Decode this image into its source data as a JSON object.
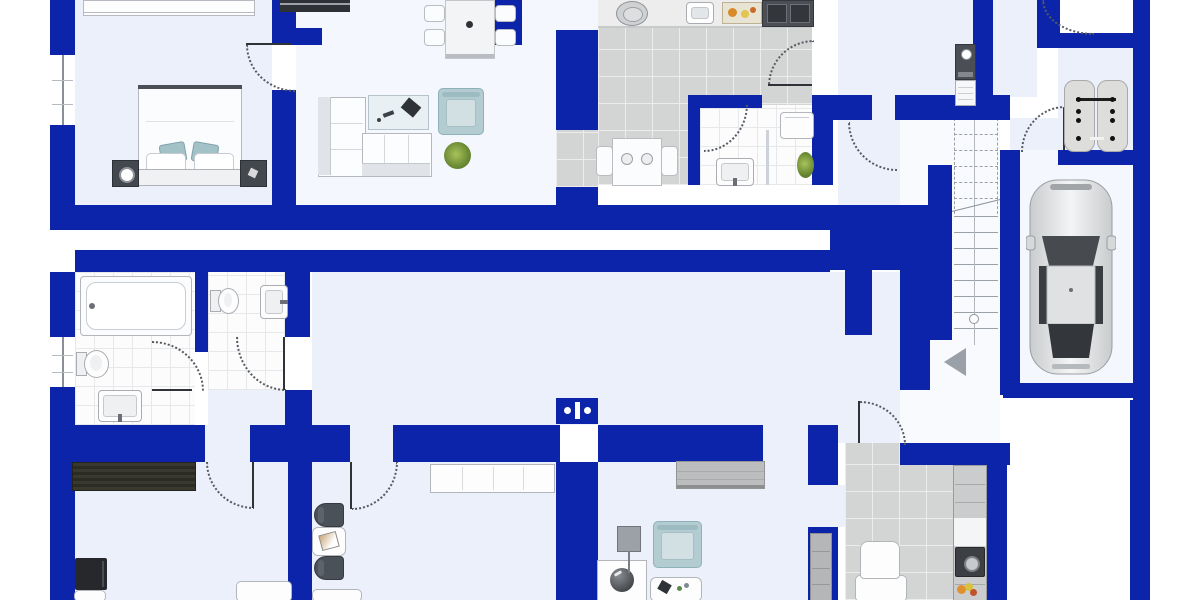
{
  "meta": {
    "title": "apartment-floor-plan"
  },
  "colors": {
    "wall": "#0c24a9",
    "floor_light": "#ebf0fb",
    "floor_bright": "#f4f7fe",
    "tile_gray": "#d3d4d4",
    "tile_white": "#fcfcfd",
    "accent_teal": "#b3ccd1",
    "dark": "#2e3136",
    "line": "#9aa0a8"
  },
  "plan": {
    "floors": [
      {
        "n": "bedroom",
        "t": "light",
        "x": 75,
        "y": 0,
        "w": 197,
        "h": 205
      },
      {
        "n": "living-room",
        "t": "bright",
        "x": 296,
        "y": 0,
        "w": 260,
        "h": 205
      },
      {
        "n": "living-kitchen-top",
        "t": "bright",
        "x": 556,
        "y": 0,
        "w": 42,
        "h": 30
      },
      {
        "n": "kitchen",
        "t": "gray",
        "x": 598,
        "y": 0,
        "w": 214,
        "h": 185
      },
      {
        "n": "kitchen-pass",
        "t": "gray",
        "x": 556,
        "y": 130,
        "w": 42,
        "h": 57
      },
      {
        "n": "bathroom-top",
        "t": "white",
        "x": 700,
        "y": 105,
        "w": 112,
        "h": 80
      },
      {
        "n": "hall-top",
        "t": "light",
        "x": 838,
        "y": 0,
        "w": 135,
        "h": 205
      },
      {
        "n": "hall-top-b",
        "t": "light",
        "x": 993,
        "y": 0,
        "w": 44,
        "h": 35
      },
      {
        "n": "hall-top-c",
        "t": "light",
        "x": 993,
        "y": 35,
        "w": 44,
        "h": 62
      },
      {
        "n": "hall-top-d",
        "t": "light",
        "x": 1010,
        "y": 118,
        "w": 48,
        "h": 32
      },
      {
        "n": "storage-room",
        "t": "light",
        "x": 1058,
        "y": 47,
        "w": 75,
        "h": 103
      },
      {
        "n": "garage",
        "t": "bright",
        "x": 1018,
        "y": 160,
        "w": 115,
        "h": 223
      },
      {
        "n": "garage-entry",
        "t": "bright",
        "x": 1018,
        "y": 150,
        "w": 40,
        "h": 15
      },
      {
        "n": "corridor-strip",
        "t": "plain",
        "x": 75,
        "y": 230,
        "w": 755,
        "h": 20
      },
      {
        "n": "hall-lower",
        "t": "light",
        "x": 312,
        "y": 272,
        "w": 588,
        "h": 153
      },
      {
        "n": "stair-hall",
        "t": "plainb",
        "x": 900,
        "y": 120,
        "w": 100,
        "h": 323
      },
      {
        "n": "bathroom-lower",
        "t": "white",
        "x": 75,
        "y": 272,
        "w": 120,
        "h": 153
      },
      {
        "n": "wc",
        "t": "white",
        "x": 208,
        "y": 272,
        "w": 77,
        "h": 118
      },
      {
        "n": "wc-lower",
        "t": "light",
        "x": 208,
        "y": 390,
        "w": 77,
        "h": 35
      },
      {
        "n": "room-bottom-left",
        "t": "light",
        "x": 75,
        "y": 462,
        "w": 213,
        "h": 138
      },
      {
        "n": "corridor-lower",
        "t": "light",
        "x": 312,
        "y": 462,
        "w": 244,
        "h": 138
      },
      {
        "n": "room-bottom-mid",
        "t": "light",
        "x": 598,
        "y": 462,
        "w": 210,
        "h": 138
      },
      {
        "n": "door-gap-mid",
        "t": "light",
        "x": 808,
        "y": 485,
        "w": 37,
        "h": 42
      },
      {
        "n": "kitchen-lower",
        "t": "gray",
        "x": 845,
        "y": 443,
        "w": 140,
        "h": 157
      },
      {
        "n": "entry-gap",
        "t": "light",
        "x": 838,
        "y": 398,
        "w": 62,
        "h": 45
      },
      {
        "n": "band-gap-1",
        "t": "light",
        "x": 205,
        "y": 425,
        "w": 45,
        "h": 37
      },
      {
        "n": "band-gap-2",
        "t": "light",
        "x": 350,
        "y": 425,
        "w": 43,
        "h": 37
      },
      {
        "n": "band-gap-3",
        "t": "light",
        "x": 763,
        "y": 425,
        "w": 45,
        "h": 37
      },
      {
        "n": "stairs-bg",
        "t": "plainb",
        "x": 952,
        "y": 118,
        "w": 48,
        "h": 227
      }
    ],
    "walls": [
      {
        "x": 50,
        "y": 0,
        "w": 25,
        "h": 55
      },
      {
        "x": 50,
        "y": 125,
        "w": 25,
        "h": 80
      },
      {
        "x": 272,
        "y": 0,
        "w": 24,
        "h": 45
      },
      {
        "x": 296,
        "y": 28,
        "w": 26,
        "h": 17
      },
      {
        "x": 272,
        "y": 90,
        "w": 24,
        "h": 115
      },
      {
        "x": 480,
        "y": 0,
        "w": 42,
        "h": 45
      },
      {
        "x": 556,
        "y": 30,
        "w": 42,
        "h": 100
      },
      {
        "x": 556,
        "y": 187,
        "w": 42,
        "h": 18
      },
      {
        "x": 50,
        "y": 205,
        "w": 805,
        "h": 25
      },
      {
        "x": 830,
        "y": 205,
        "w": 115,
        "h": 65
      },
      {
        "x": 75,
        "y": 250,
        "w": 755,
        "h": 22
      },
      {
        "x": 688,
        "y": 95,
        "w": 74,
        "h": 13
      },
      {
        "x": 688,
        "y": 108,
        "w": 12,
        "h": 77
      },
      {
        "x": 812,
        "y": 95,
        "w": 60,
        "h": 25
      },
      {
        "x": 895,
        "y": 95,
        "w": 115,
        "h": 25
      },
      {
        "x": 812,
        "y": 120,
        "w": 21,
        "h": 65
      },
      {
        "x": 973,
        "y": 0,
        "w": 20,
        "h": 110
      },
      {
        "x": 1037,
        "y": 0,
        "w": 23,
        "h": 35
      },
      {
        "x": 1037,
        "y": 33,
        "w": 98,
        "h": 15
      },
      {
        "x": 1058,
        "y": 150,
        "w": 77,
        "h": 15
      },
      {
        "x": 1133,
        "y": 0,
        "w": 17,
        "h": 403
      },
      {
        "x": 928,
        "y": 165,
        "w": 24,
        "h": 175
      },
      {
        "x": 1000,
        "y": 150,
        "w": 20,
        "h": 245
      },
      {
        "x": 1003,
        "y": 383,
        "w": 140,
        "h": 15
      },
      {
        "x": 845,
        "y": 270,
        "w": 27,
        "h": 65
      },
      {
        "x": 900,
        "y": 270,
        "w": 30,
        "h": 120
      },
      {
        "x": 1130,
        "y": 400,
        "w": 20,
        "h": 200
      },
      {
        "x": 50,
        "y": 272,
        "w": 25,
        "h": 65
      },
      {
        "x": 50,
        "y": 387,
        "w": 25,
        "h": 213
      },
      {
        "x": 195,
        "y": 272,
        "w": 13,
        "h": 80
      },
      {
        "x": 285,
        "y": 272,
        "w": 25,
        "h": 65
      },
      {
        "x": 285,
        "y": 390,
        "w": 27,
        "h": 35
      },
      {
        "x": 50,
        "y": 425,
        "w": 155,
        "h": 37
      },
      {
        "x": 250,
        "y": 425,
        "w": 100,
        "h": 37
      },
      {
        "x": 393,
        "y": 425,
        "w": 167,
        "h": 37
      },
      {
        "x": 598,
        "y": 425,
        "w": 165,
        "h": 37
      },
      {
        "x": 808,
        "y": 425,
        "w": 30,
        "h": 60
      },
      {
        "x": 808,
        "y": 527,
        "w": 30,
        "h": 73
      },
      {
        "x": 288,
        "y": 462,
        "w": 24,
        "h": 138
      },
      {
        "x": 556,
        "y": 462,
        "w": 42,
        "h": 138
      },
      {
        "x": 900,
        "y": 443,
        "w": 110,
        "h": 22
      },
      {
        "x": 985,
        "y": 443,
        "w": 22,
        "h": 157
      }
    ],
    "windows": [
      {
        "n": "window-bedroom",
        "x": 50,
        "y": 55,
        "w": 25,
        "h": 70
      },
      {
        "n": "window-bathroom",
        "x": 50,
        "y": 337,
        "w": 25,
        "h": 50
      }
    ],
    "doors": [
      {
        "n": "door-bedroom",
        "x": 246,
        "y": 45,
        "w": 48,
        "h": 45,
        "c": "bl",
        "leaf": {
          "x": 246,
          "y": 43,
          "w": 46,
          "h": 2
        }
      },
      {
        "n": "door-kitchen",
        "x": 768,
        "y": 40,
        "w": 44,
        "h": 44,
        "c": "tl",
        "leaf": {
          "x": 768,
          "y": 84,
          "w": 44,
          "h": 2
        }
      },
      {
        "n": "door-bath-top",
        "x": 704,
        "y": 104,
        "w": 42,
        "h": 46,
        "c": "br"
      },
      {
        "n": "door-storage",
        "x": 1021,
        "y": 106,
        "w": 42,
        "h": 44,
        "c": "tl",
        "leaf": {
          "x": 1063,
          "y": 108,
          "w": 2,
          "h": 42
        }
      },
      {
        "n": "door-entry-top",
        "x": 1042,
        "y": 0,
        "w": 50,
        "h": 33,
        "c": "bl"
      },
      {
        "n": "door-hall",
        "x": 848,
        "y": 122,
        "w": 47,
        "h": 47,
        "c": "bl"
      },
      {
        "n": "door-wc",
        "x": 236,
        "y": 337,
        "w": 48,
        "h": 52,
        "c": "bl",
        "leaf": {
          "x": 283,
          "y": 337,
          "w": 2,
          "h": 53
        }
      },
      {
        "n": "door-bath-lower",
        "x": 152,
        "y": 341,
        "w": 50,
        "h": 48,
        "c": "tr",
        "leaf": {
          "x": 152,
          "y": 389,
          "w": 40,
          "h": 2
        }
      },
      {
        "n": "door-room-left",
        "x": 206,
        "y": 462,
        "w": 46,
        "h": 45,
        "c": "bl",
        "leaf": {
          "x": 252,
          "y": 462,
          "w": 2,
          "h": 46
        }
      },
      {
        "n": "door-corridor",
        "x": 352,
        "y": 462,
        "w": 44,
        "h": 46,
        "c": "br",
        "leaf": {
          "x": 350,
          "y": 462,
          "w": 2,
          "h": 47
        }
      },
      {
        "n": "door-kitchen-lower",
        "x": 860,
        "y": 401,
        "w": 44,
        "h": 42,
        "c": "tr",
        "leaf": {
          "x": 858,
          "y": 401,
          "w": 2,
          "h": 42
        }
      }
    ],
    "stairs": {
      "x": 952,
      "y": 118,
      "w": 48,
      "dashed": [
        118,
        134,
        150,
        166,
        182,
        198
      ],
      "solid": [
        216,
        232,
        248,
        264,
        280,
        296,
        312,
        328
      ],
      "center": 974,
      "diag": {
        "x": 950,
        "y": 205,
        "w": 52
      },
      "circle": {
        "x": 969,
        "y": 314
      }
    },
    "furniture": [
      {
        "n": "wardrobe",
        "t": "wardrobe",
        "x": 83,
        "y": 0,
        "w": 170,
        "h": 14
      },
      {
        "n": "double-bed",
        "t": "bed",
        "x": 138,
        "y": 85,
        "w": 104,
        "h": 101
      },
      {
        "n": "nightstand-left",
        "t": "nightstand",
        "x": 112,
        "y": 160,
        "w": 25,
        "h": 25,
        "lamp": true
      },
      {
        "n": "nightstand-right",
        "t": "nightstand",
        "x": 240,
        "y": 160,
        "w": 25,
        "h": 25
      },
      {
        "n": "piano",
        "t": "piano",
        "x": 280,
        "y": 0,
        "w": 70,
        "h": 12
      },
      {
        "n": "dining-table",
        "t": "table",
        "x": 445,
        "y": 0,
        "w": 48,
        "h": 57
      },
      {
        "n": "dining-chair-1",
        "t": "chair",
        "x": 424,
        "y": 5,
        "w": 19,
        "h": 15
      },
      {
        "n": "dining-chair-2",
        "t": "chair",
        "x": 424,
        "y": 29,
        "w": 19,
        "h": 15
      },
      {
        "n": "dining-chair-3",
        "t": "chair",
        "x": 495,
        "y": 5,
        "w": 19,
        "h": 15
      },
      {
        "n": "dining-chair-4",
        "t": "chair",
        "x": 495,
        "y": 29,
        "w": 19,
        "h": 15
      },
      {
        "n": "corner-sofa",
        "t": "sofa",
        "x": 318,
        "y": 97,
        "w": 112,
        "h": 78
      },
      {
        "n": "coffee-table",
        "t": "ctable",
        "x": 368,
        "y": 95,
        "w": 59,
        "h": 33
      },
      {
        "n": "armchair",
        "t": "armchair",
        "x": 438,
        "y": 88,
        "w": 44,
        "h": 45
      },
      {
        "n": "plant",
        "t": "plant",
        "x": 444,
        "y": 142,
        "w": 27,
        "h": 27
      },
      {
        "n": "kitchen-counter",
        "t": "counter",
        "x": 598,
        "y": 0,
        "w": 214,
        "h": 26
      },
      {
        "n": "pot",
        "t": "pot",
        "x": 616,
        "y": 1,
        "w": 30,
        "h": 23
      },
      {
        "n": "kitchen-sink",
        "t": "ksink",
        "x": 686,
        "y": 2,
        "w": 26,
        "h": 20
      },
      {
        "n": "cutting-board",
        "t": "board",
        "x": 722,
        "y": 2,
        "w": 38,
        "h": 20
      },
      {
        "n": "stove",
        "t": "stove",
        "x": 762,
        "y": 0,
        "w": 50,
        "h": 25
      },
      {
        "n": "kitchen-table",
        "t": "ktable",
        "x": 612,
        "y": 138,
        "w": 48,
        "h": 46
      },
      {
        "n": "kitchen-chair-1",
        "t": "chairv",
        "x": 596,
        "y": 146,
        "w": 15,
        "h": 28
      },
      {
        "n": "kitchen-chair-2",
        "t": "chairv",
        "x": 661,
        "y": 146,
        "w": 15,
        "h": 28
      },
      {
        "n": "bath-top-sink",
        "t": "sink",
        "x": 716,
        "y": 158,
        "w": 36,
        "h": 26,
        "f": "b"
      },
      {
        "n": "washing-machine",
        "t": "washer",
        "x": 780,
        "y": 112,
        "w": 32,
        "h": 25
      },
      {
        "n": "bath-top-plant",
        "t": "plant",
        "x": 797,
        "y": 152,
        "w": 17,
        "h": 26
      },
      {
        "n": "bath-divider",
        "t": "divider",
        "x": 766,
        "y": 130,
        "w": 3,
        "h": 55
      },
      {
        "n": "water-heater",
        "t": "heater",
        "x": 955,
        "y": 44,
        "w": 19,
        "h": 34
      },
      {
        "n": "radiator",
        "t": "radiator",
        "x": 955,
        "y": 80,
        "w": 19,
        "h": 24
      },
      {
        "n": "storage-pads",
        "t": "pads",
        "x": 1064,
        "y": 80,
        "w": 64,
        "h": 70
      },
      {
        "n": "car",
        "t": "car",
        "x": 1026,
        "y": 178,
        "w": 90,
        "h": 198
      },
      {
        "n": "stairs-arrow",
        "t": "arrow",
        "x": 944,
        "y": 348,
        "w": 24,
        "h": 28
      },
      {
        "n": "bathtub",
        "t": "bathtub",
        "x": 80,
        "y": 276,
        "w": 110,
        "h": 58
      },
      {
        "n": "toilet-1",
        "t": "toilet",
        "x": 76,
        "y": 349,
        "w": 32,
        "h": 28
      },
      {
        "n": "bath-sink",
        "t": "sink",
        "x": 98,
        "y": 390,
        "w": 42,
        "h": 30,
        "f": "b"
      },
      {
        "n": "toilet-2",
        "t": "toilet",
        "x": 210,
        "y": 287,
        "w": 28,
        "h": 26
      },
      {
        "n": "wc-sink",
        "t": "sink",
        "x": 260,
        "y": 285,
        "w": 26,
        "h": 32,
        "f": "r"
      },
      {
        "n": "rug",
        "t": "rug",
        "x": 72,
        "y": 462,
        "w": 122,
        "h": 27
      },
      {
        "n": "tv",
        "t": "tv",
        "x": 75,
        "y": 558,
        "w": 32,
        "h": 32
      },
      {
        "n": "tv-stand",
        "t": "whitebox",
        "x": 74,
        "y": 590,
        "w": 30,
        "h": 10
      },
      {
        "n": "side-chair-1",
        "t": "chairdark",
        "x": 314,
        "y": 503,
        "w": 28,
        "h": 22
      },
      {
        "n": "side-table",
        "t": "tray",
        "x": 312,
        "y": 527,
        "w": 32,
        "h": 27,
        "variant": "photo"
      },
      {
        "n": "side-chair-2",
        "t": "chairdark",
        "x": 314,
        "y": 556,
        "w": 28,
        "h": 22
      },
      {
        "n": "cabinet-cut-1",
        "t": "whitebox",
        "x": 236,
        "y": 581,
        "w": 54,
        "h": 19
      },
      {
        "n": "cabinet-cut-2",
        "t": "whitebox",
        "x": 312,
        "y": 589,
        "w": 48,
        "h": 11
      },
      {
        "n": "hall-shelf",
        "t": "shelf",
        "x": 430,
        "y": 464,
        "w": 123,
        "h": 27
      },
      {
        "n": "sideboard",
        "t": "sideboard",
        "x": 676,
        "y": 461,
        "w": 87,
        "h": 26
      },
      {
        "n": "armchair-2",
        "t": "armchair",
        "x": 653,
        "y": 521,
        "w": 47,
        "h": 45
      },
      {
        "n": "activity-table",
        "t": "tray",
        "x": 650,
        "y": 577,
        "w": 50,
        "h": 23,
        "variant": "game"
      },
      {
        "n": "desk-globe",
        "t": "globe",
        "x": 597,
        "y": 560,
        "w": 48,
        "h": 40
      },
      {
        "n": "floor-lamp",
        "t": "lamp",
        "x": 617,
        "y": 526,
        "w": 22,
        "h": 24
      },
      {
        "n": "tall-cabinet",
        "t": "tallcab",
        "x": 810,
        "y": 533,
        "w": 20,
        "h": 67
      },
      {
        "n": "kitchen2-cabinets",
        "t": "cabcol",
        "x": 953,
        "y": 465,
        "w": 32,
        "h": 135
      },
      {
        "n": "built-in-oven",
        "t": "oven",
        "x": 955,
        "y": 547,
        "w": 28,
        "h": 28
      },
      {
        "n": "fruit-bowl",
        "t": "fruit",
        "x": 957,
        "y": 583,
        "w": 20,
        "h": 14
      },
      {
        "n": "desk-2",
        "t": "whitebox",
        "x": 855,
        "y": 575,
        "w": 50,
        "h": 25
      },
      {
        "n": "desk-chair",
        "t": "chairw",
        "x": 860,
        "y": 541,
        "w": 38,
        "h": 36
      },
      {
        "n": "wall-panel",
        "t": "panel",
        "x": 556,
        "y": 398,
        "w": 42,
        "h": 26
      }
    ]
  }
}
